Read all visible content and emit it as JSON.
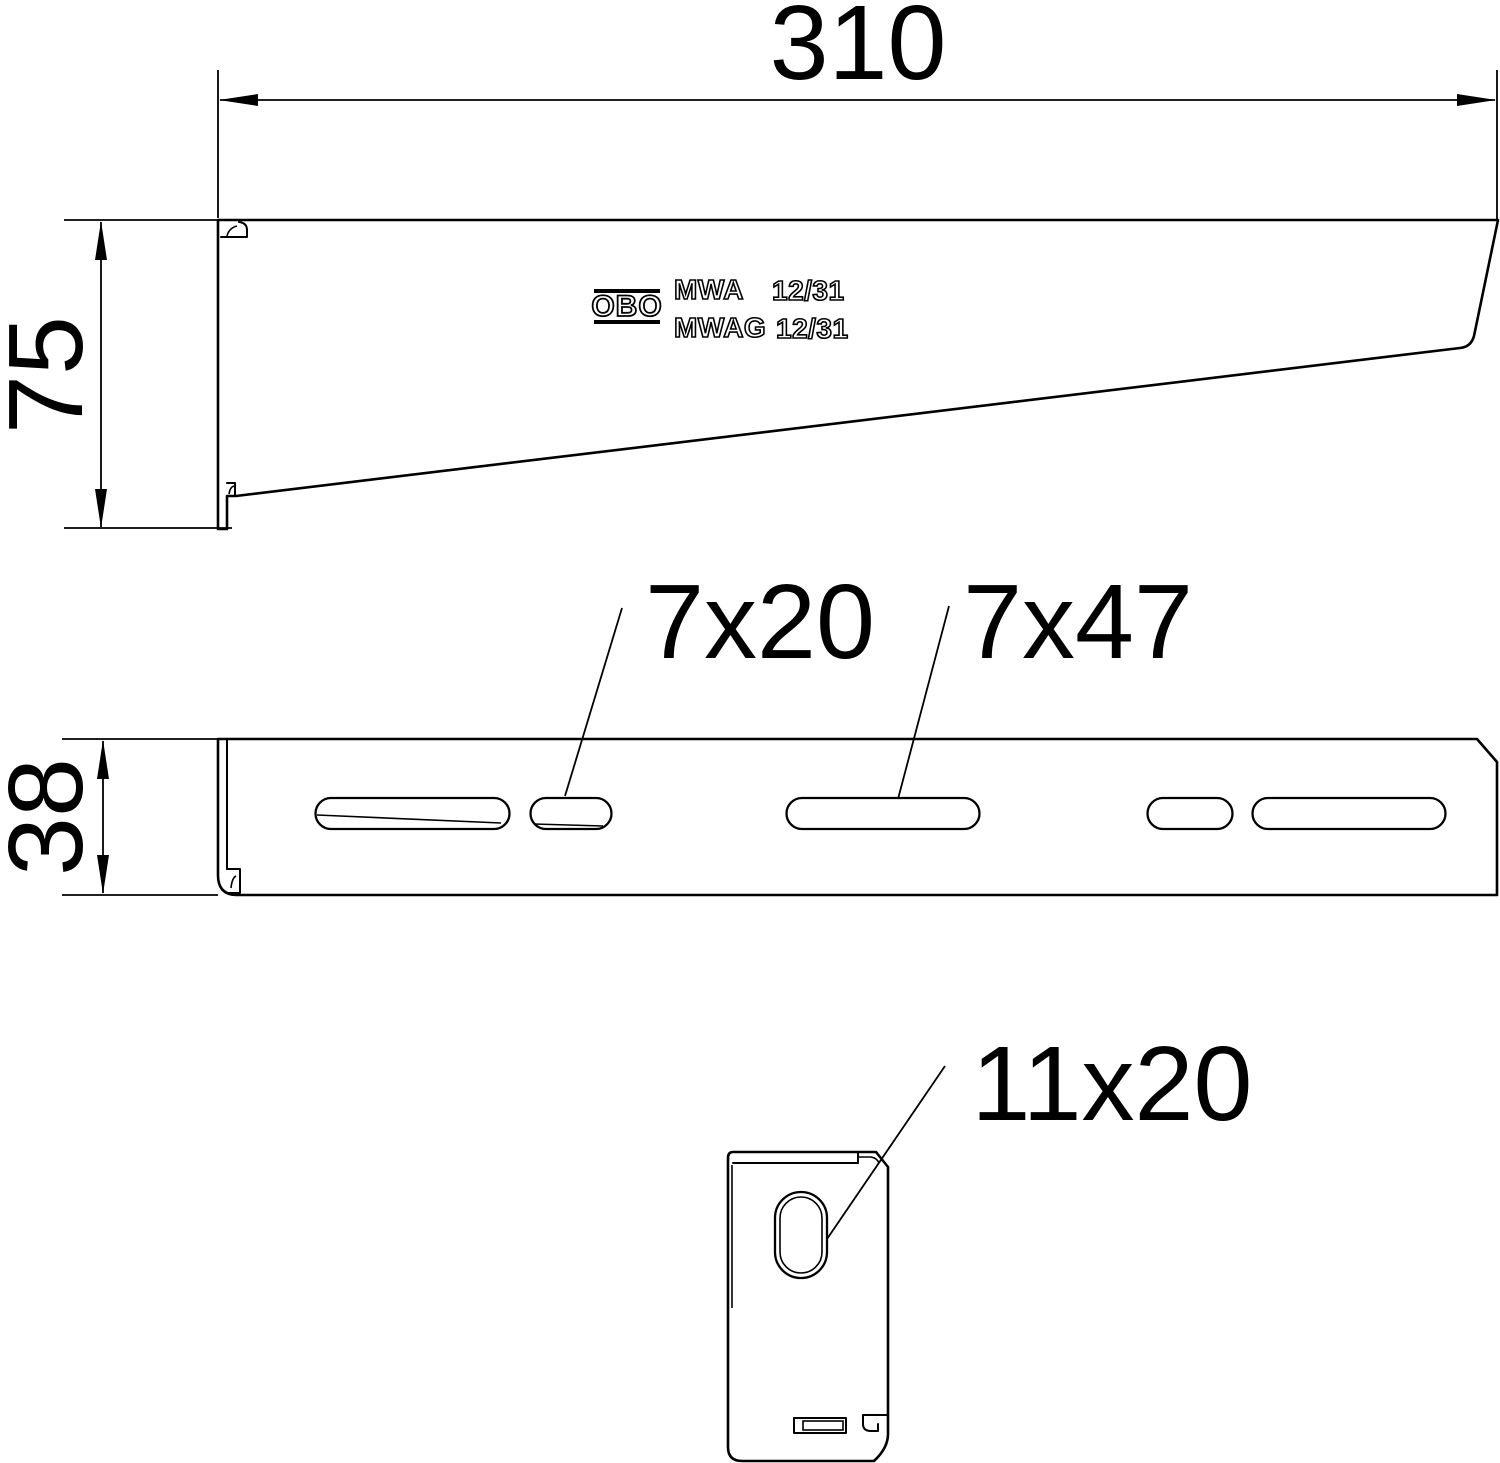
{
  "drawing": {
    "background": "#ffffff",
    "line_color": "#000000",
    "dimensions": {
      "total_length": "310",
      "side_height": "75",
      "arm_width": "38",
      "slot_short": "7x20",
      "slot_long": "7x47",
      "plate_slot": "11x20"
    },
    "branding": {
      "logo": "OBO",
      "model_line1": "MWA",
      "size_line1": "12/31",
      "model_line2": "MWAG",
      "size_line2": "12/31"
    }
  }
}
